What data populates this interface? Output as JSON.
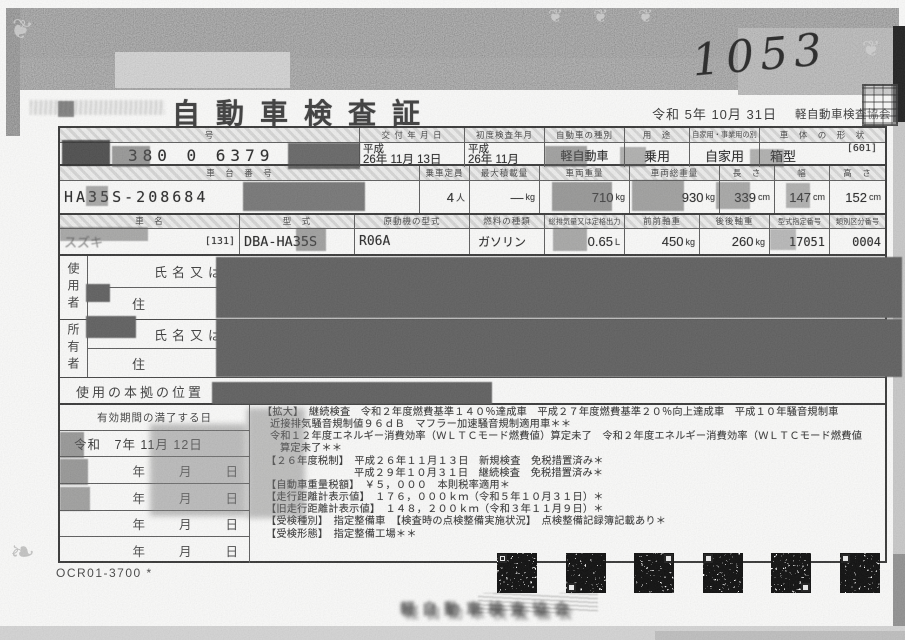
{
  "meta": {
    "handwritten_number": "1053",
    "title": "自動車検査証",
    "issue_date": "令和 5年 10月 31日",
    "issuer": "軽自動車検査協会",
    "ocr_code": "OCR01-3700 *",
    "bottom_stamp_text": "軽自動車検査協会"
  },
  "t1": {
    "h_number": "号",
    "h_issue": "交 付 年 月 日",
    "h_first": "初度検査年月",
    "h_kind": "自動車の種別",
    "h_use": "用　途",
    "h_own": "自家用・事業用の別",
    "h_shape": "車　体　の　形　状",
    "number": "380 0 6379",
    "issue_era": "平成",
    "issue_date": "26年 11月 13日",
    "first_era": "平成",
    "first_date": "26年 11月",
    "kind": "軽自動車",
    "use": "乗用",
    "own": "自家用",
    "shape": "箱型",
    "form_code": "[601]"
  },
  "t2": {
    "h_chassis": "車　台　番　号",
    "h_cap": "乗車定員",
    "h_load": "最大積載量",
    "h_weight": "車両重量",
    "h_gross": "車両総重量",
    "h_len": "長　さ",
    "h_wid": "幅",
    "h_hei": "高　さ",
    "chassis": "HA35S-208684",
    "cap": "4",
    "cap_u": "人",
    "load": "―",
    "load_u": "kg",
    "weight": "710",
    "weight_u": "kg",
    "gross": "930",
    "gross_u": "kg",
    "len": "339",
    "len_u": "cm",
    "wid": "147",
    "wid_u": "cm",
    "hei": "152",
    "hei_u": "cm"
  },
  "t3": {
    "h_maker": "車　名",
    "h_model": "型　式",
    "h_engine": "原動機の型式",
    "h_fuel": "燃料の種類",
    "h_disp": "総排気量又は定格出力",
    "h_front": "前前軸重",
    "h_rear": "後後軸重",
    "h_typeno": "型式指定番号",
    "h_classno": "類別区分番号",
    "maker": "スズキ",
    "maker_code": "[131]",
    "model": "DBA-HA35S",
    "engine": "R06A",
    "fuel": "ガソリン",
    "disp": "0.65",
    "disp_u": "L",
    "front": "450",
    "front_u": "kg",
    "rear": "260",
    "rear_u": "kg",
    "typeno": "17051",
    "classno": "0004"
  },
  "parties": {
    "user": "使用者",
    "owner": "所有者",
    "name_label": "氏名又は名称",
    "addr_label": "住　　　所",
    "name_label2": "氏名又は名称",
    "addr_label2": "住　　　所",
    "base_label": "使用の本拠の位置"
  },
  "validity": {
    "label": "有効期間の満了する日",
    "row1": "令和　7年 11月 12日",
    "row2": "年　　月　　日",
    "row3": "年　　月　　日",
    "row4": "年　　月　　日",
    "row5": "年　　月　　日"
  },
  "remarks": {
    "lines": [
      "【拡大】　継続検査　令和２年度燃費基準１４０％達成車　平成２７年度燃費基準２０％向上達成車　平成１０年騒音規制車",
      "近接排気騒音規制値９６ｄＢ　マフラー加速騒音規制適用車＊＊",
      "令和１２年度エネルギー消費効率（ＷＬＴＣモード燃費値）算定未了　令和２年度エネルギー消費効率（ＷＬＴＣモード燃費値",
      "算定未了＊＊",
      "【２６年度税制】　平成２６年１１月１３日　新規検査　免税措置済み＊",
      "平成２９年１０月３１日　継続検査　免税措置済み＊",
      "【自動車重量税額】　￥５，０００　本則税率適用＊",
      "【走行距離計表示値】　１７６，０００ｋｍ（令和５年１０月３１日）＊",
      "【旧走行距離計表示値】　１４８，２００ｋｍ（令和３年１１月９日）＊",
      "【受検種別】　指定整備車　【検査時の点検整備実施状況】　点検整備記録簿記載あり＊",
      "【受検形態】　指定整備工場＊＊"
    ]
  }
}
